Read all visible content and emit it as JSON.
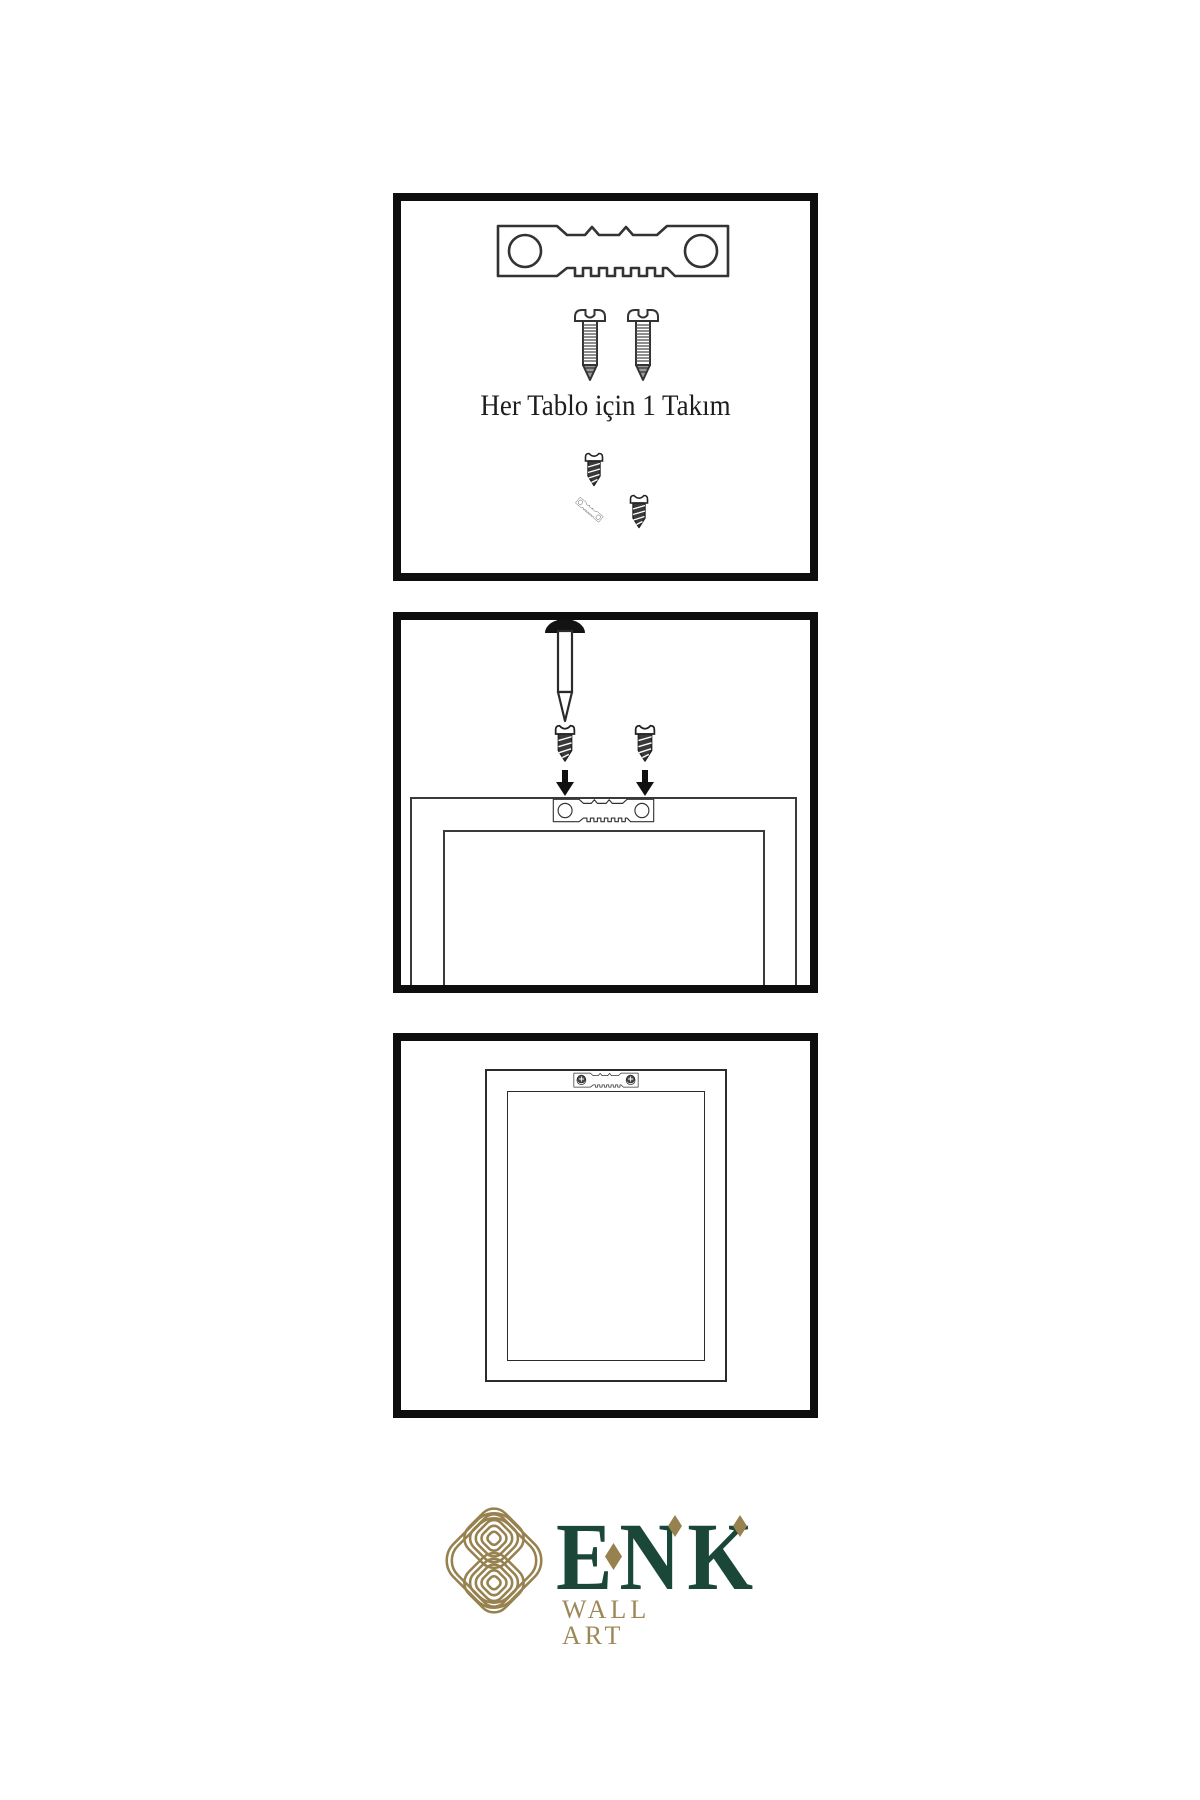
{
  "meta": {
    "sheet_type": "wall-art hanging instructions"
  },
  "colors": {
    "background": "#ffffff",
    "panel_border": "#0e0e0e",
    "line_art": "#333333",
    "logo_green": "#1a4738",
    "logo_gold": "#97814f",
    "logo_gold_light": "#9d8858"
  },
  "panels": {
    "panel1": {
      "caption": "Her Tablo için 1 Takım",
      "icons": [
        "sawtooth-hanger-icon",
        "screw-icon",
        "screw-icon",
        "dark-screw-icon",
        "angled-sawtooth-hanger-icon",
        "dark-screw-icon"
      ]
    },
    "panel2": {
      "icons": [
        "wall-nail-icon",
        "dark-screw-icon",
        "dark-screw-icon",
        "down-arrow-icon",
        "down-arrow-icon",
        "frame-back-icon",
        "sawtooth-hanger-icon"
      ]
    },
    "panel3": {
      "icons": [
        "frame-back-icon",
        "mounted-sawtooth-hanger-icon",
        "phillips-screw-icon",
        "phillips-screw-icon"
      ]
    }
  },
  "logo": {
    "brand": "ENK",
    "tagline": "WALL ART",
    "mark": "interlaced-knot-icon"
  }
}
